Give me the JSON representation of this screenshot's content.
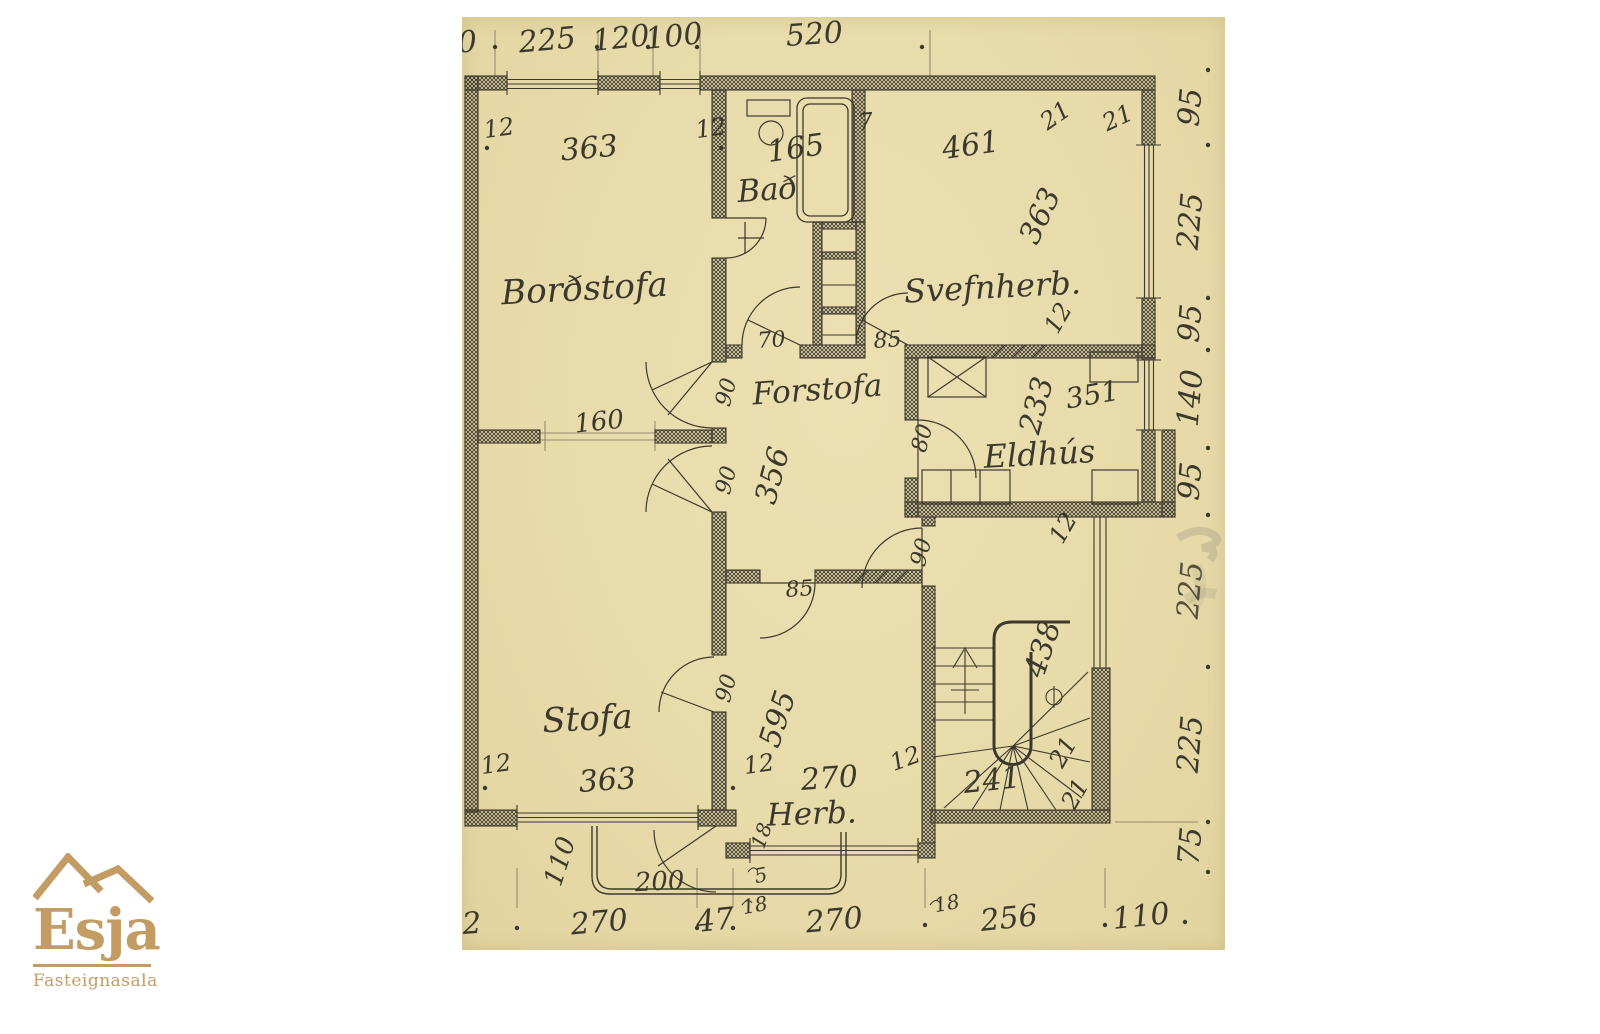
{
  "logo": {
    "name": "Esja",
    "subtitle": "Fasteignasala",
    "color": "#c29c62"
  },
  "plan": {
    "paper_color": "#e8dbaa",
    "ink_color": "#3d382d",
    "rooms": {
      "bordstofa": "Borðstofa",
      "bad": "Bað",
      "svefnherb": "Svefnherb.",
      "forstofa": "Forstofa",
      "eldhus": "Eldhús",
      "stofa": "Stofa",
      "herb": "Herb."
    },
    "dims": {
      "top": [
        "0",
        "225",
        "120",
        "100",
        "520"
      ],
      "right": [
        "95",
        "225",
        "95",
        "140",
        "95",
        "225",
        "225",
        "75"
      ],
      "bottom": [
        "92",
        "270",
        "47",
        "18",
        "270",
        "18",
        "256",
        "110"
      ],
      "bordstofa_width": "363",
      "bad_width": "165",
      "svefnherb_width": "461",
      "svefnherb_height": "363",
      "forstofa_height": "356",
      "eldhus_height": "233",
      "eldhus_width": "351",
      "opening_width": "160",
      "stofa_width": "363",
      "herb_height": "595",
      "herb_width": "270",
      "stair_width": "241",
      "stair_height": "438",
      "porch_width": "200",
      "porch_height": "110",
      "small": {
        "t12": "12",
        "t7": "7",
        "t21": "21",
        "t85": "85",
        "t70": "70",
        "t90": "90",
        "t80": "80",
        "t18": "18",
        "t5": "5"
      }
    }
  }
}
